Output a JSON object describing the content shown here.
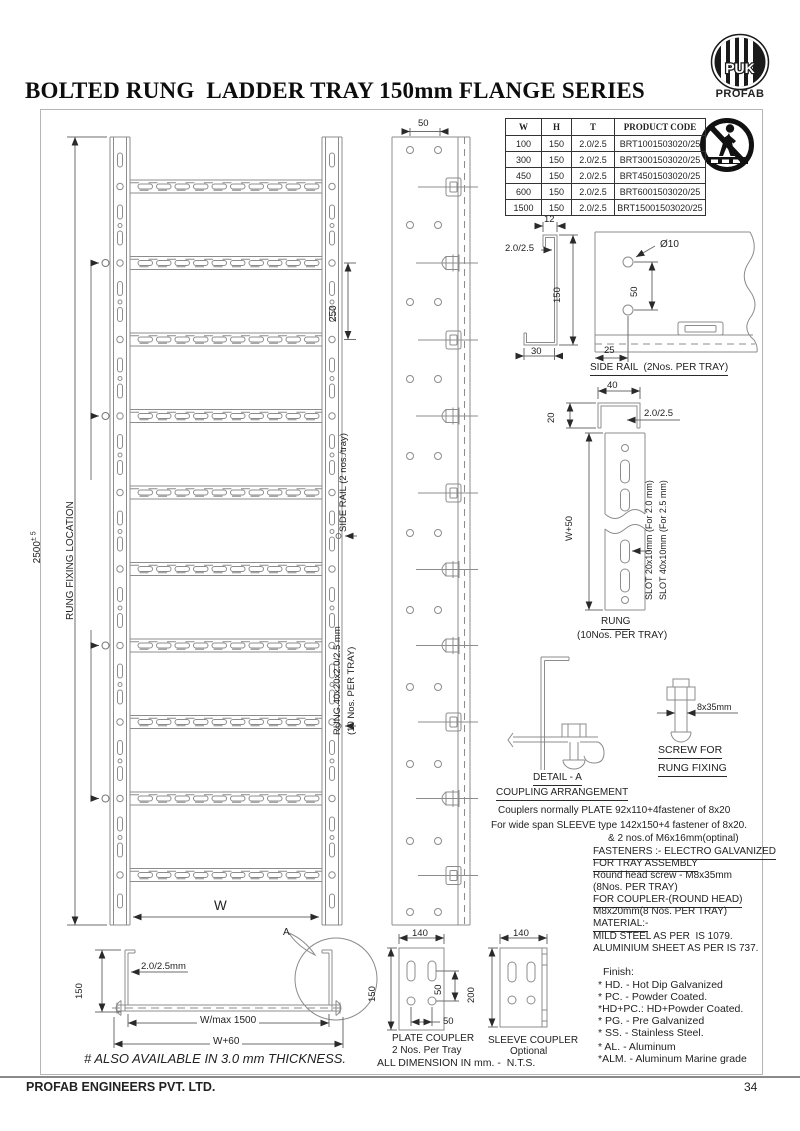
{
  "page": {
    "title": "BOLTED RUNG  LADDER TRAY 150mm FLANGE SERIES",
    "footer_company": "PROFAB ENGINEERS PVT. LTD.",
    "footer_page": "34"
  },
  "logo": {
    "monogram": "PUK",
    "brand": "PROFAB"
  },
  "spec_table": {
    "headers": [
      "W",
      "H",
      "T",
      "PRODUCT CODE"
    ],
    "rows": [
      [
        "100",
        "150",
        "2.0/2.5",
        "BRT1001503020/25"
      ],
      [
        "300",
        "150",
        "2.0/2.5",
        "BRT3001503020/25"
      ],
      [
        "450",
        "150",
        "2.0/2.5",
        "BRT4501503020/25"
      ],
      [
        "600",
        "150",
        "2.0/2.5",
        "BRT6001503020/25"
      ],
      [
        "1500",
        "150",
        "2.0/2.5",
        "BRT15001503020/25"
      ]
    ]
  },
  "plan_view": {
    "overall_length": "2500",
    "tolerance": "± 5",
    "fixing_label": "RUNG FIXING LOCATION",
    "rung_spacing": "250",
    "side_rail_callout": "SIDE RAIL (2 nos./tray)",
    "rung_callout_1": "RUNG.40x20x2.0/2.5 mm",
    "rung_callout_2": "(10 Nos. PER TRAY)",
    "width": "W",
    "hole_pitch": "50"
  },
  "side_rail_detail": {
    "flange": "12",
    "thickness": "2.0/2.5",
    "height": "150",
    "bottom_flange": "30",
    "hole_dia": "Ø10",
    "hole_pitch": "50",
    "edge_distance": "25",
    "caption": "SIDE RAIL  (2Nos. PER TRAY)"
  },
  "rung_detail": {
    "width": "40",
    "depth": "20",
    "thickness": "2.0/2.5",
    "length": "W+50",
    "slot_small": "SLOT 20x10mm (For 2.0 mm)",
    "slot_large": "SLOT 40x10mm (For 2.5 mm)",
    "caption": "RUNG",
    "quantity": "(10Nos. PER TRAY)"
  },
  "detail_a": {
    "ref": "A",
    "caption": "DETAIL - A",
    "title": "COUPLING ARRANGEMENT"
  },
  "screw_detail": {
    "size": "8x35mm",
    "caption_1": "SCREW FOR",
    "caption_2": "RUNG FIXING"
  },
  "notes": {
    "coupler_1": "Couplers normally PLATE 92x110+4fastener of 8x20",
    "coupler_2": "For wide span SLEEVE type 142x150+4 fastener of 8x20.",
    "coupler_3": "& 2 nos.of M6x16mm(optinal)",
    "fasteners_heading": "FASTENERS :- ELECTRO GALVANIZED",
    "assembly_heading": "FOR TRAY ASSEMBLY",
    "assembly_line_1": "Round head screw - M8x35mm",
    "assembly_line_2": "(8Nos. PER TRAY)",
    "coupler_heading": "FOR COUPLER-(ROUND HEAD)",
    "coupler_line": "M8x20mm(8 Nos. PER TRAY)",
    "material_heading": "MATERIAL:-",
    "material_line_1": "MILD STEEL AS PER  IS 1079.",
    "material_line_2": "ALUMINIUM SHEET AS PER IS 737."
  },
  "finish": {
    "heading": "Finish:",
    "items": [
      "* HD. - Hot Dip Galvanized",
      "* PC. - Powder Coated.",
      "*HD+PC.: HD+Powder Coated.",
      "* PG. - Pre Galvanized",
      "* SS. - Stainless Steel.",
      "* AL. - Aluminum",
      "*ALM. - Aluminum Marine grade"
    ]
  },
  "cross_section": {
    "height": "150",
    "thickness": "2.0/2.5mm",
    "span": "W/max 1500",
    "overall_width": "W+60",
    "detail_ref": "A"
  },
  "plate_coupler": {
    "width": "140",
    "height": "150",
    "hole_pitch_v": "50",
    "hole_pitch_h": "50",
    "caption": "PLATE COUPLER",
    "quantity": "2 Nos. Per Tray"
  },
  "sleeve_coupler": {
    "width": "140",
    "height": "200",
    "caption": "SLEEVE COUPLER",
    "quantity": "Optional"
  },
  "footnotes": {
    "dimension_note": "ALL DIMENSION IN mm. -  N.T.S.",
    "thickness_note": "# ALSO AVAILABLE IN 3.0 mm THICKNESS."
  }
}
